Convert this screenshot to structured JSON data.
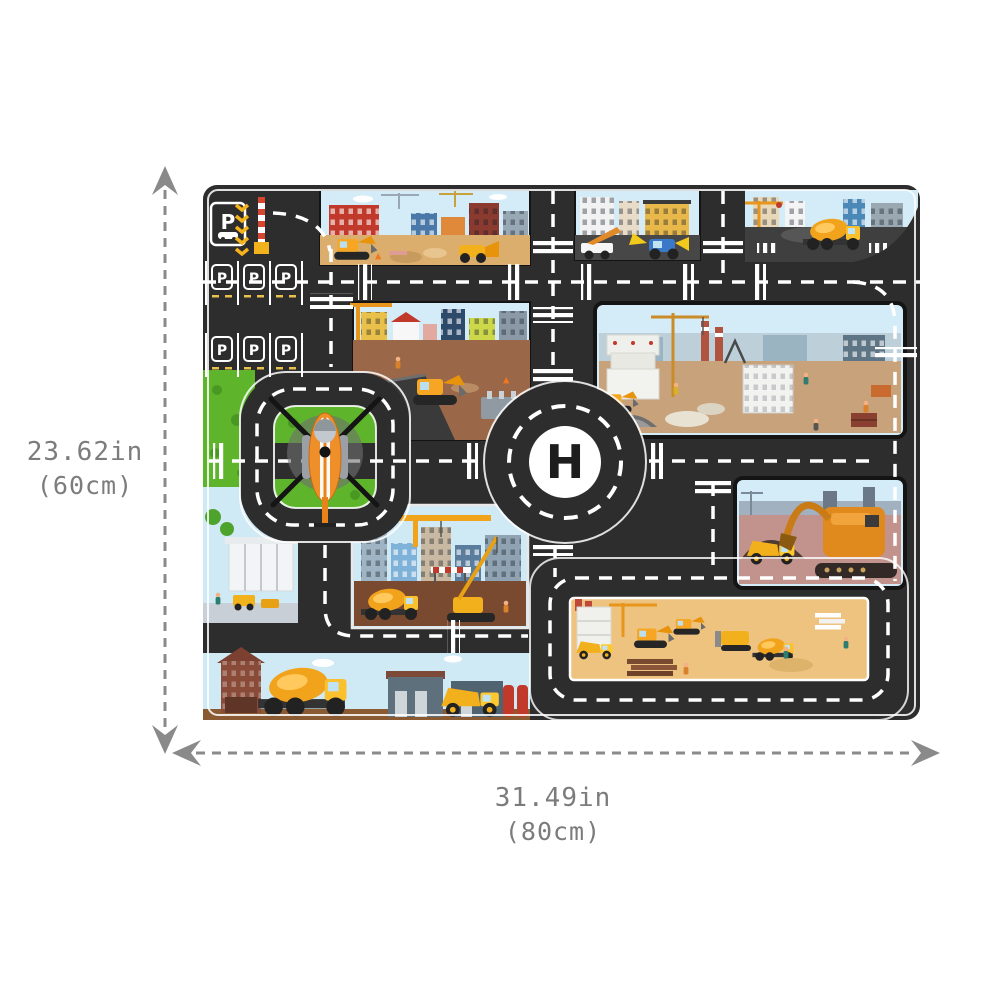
{
  "annotations": {
    "height": {
      "inches": "23.62in",
      "cm": "(60cm)"
    },
    "width": {
      "inches": "31.49in",
      "cm": "(80cm)"
    }
  },
  "mat": {
    "helipad_letter": "H",
    "parking_sign_letter": "P",
    "parking_stall_letter": "P"
  },
  "colors": {
    "road": "#2d2d2d",
    "grass": "#5eb52c",
    "sand": "#e3b676",
    "dirt": "#9a6848",
    "mauve": "#c2938d",
    "sky": "#cfe9f5",
    "label_gray": "#7c7c7c",
    "vehicle_yellow": "#f2b01d",
    "vehicle_orange": "#ef8f2a",
    "marking_white": "#ffffff"
  }
}
